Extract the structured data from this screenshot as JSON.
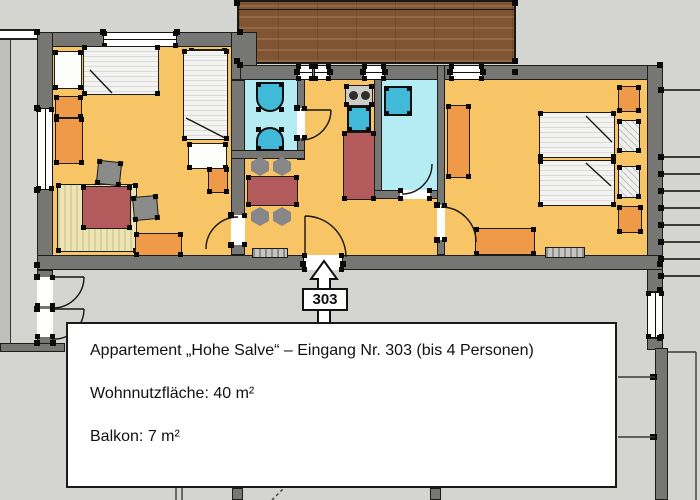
{
  "caption": {
    "line1": "Appartement „Hohe Salve“ – Eingang Nr. 303 (bis 4 Personen)",
    "line2": "Wohnnutzfläche: 40 m²",
    "line3": "Balkon: 7 m²"
  },
  "entrance": {
    "label": "303"
  },
  "colors": {
    "background": "#d4d4d0",
    "wall_gray": "#767674",
    "floor_orange": "#f7c565",
    "wet_room_cyan": "#b5ebf3",
    "fixture_blue": "#41b9d9",
    "furniture_orange": "#ef9a48",
    "table_red": "#b35a5c",
    "balcony_wood": "#8a5c38",
    "rug_beige": "#ece4b4"
  }
}
